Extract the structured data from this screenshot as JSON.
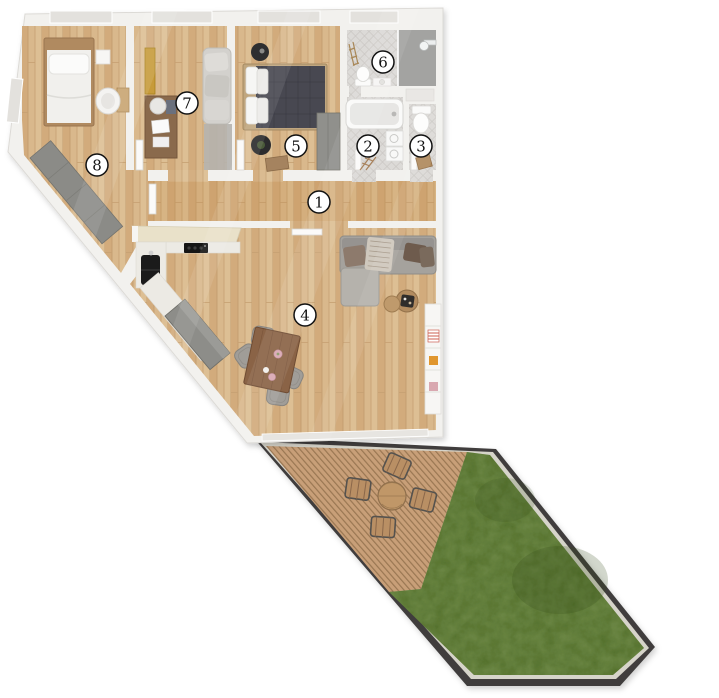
{
  "floorplan": {
    "type": "apartment-top-view-3d-floor-plan",
    "rooms": [
      {
        "number": "1"
      },
      {
        "number": "2"
      },
      {
        "number": "3"
      },
      {
        "number": "4"
      },
      {
        "number": "5"
      },
      {
        "number": "6"
      },
      {
        "number": "7"
      },
      {
        "number": "8"
      }
    ],
    "badge": {
      "fill": "#ffffff",
      "border": "#111111"
    },
    "colors": {
      "wall": "#f2f1ee",
      "wall_edge": "#dcdad6",
      "wood_floor": "#d9b88c",
      "hall_tint": "rgba(186,122,52,0.16)",
      "tile_floor": "#dcdad7",
      "shower_floor": "#a3a3a1",
      "deck_wood": "#c89f78",
      "deck_slat": "#9a7753",
      "grass": "#527029",
      "terrace_border": "#3f3e3c",
      "terrace_frame": "#d6d4ca",
      "furniture_gray": "#8d8d89",
      "sofa_gray": "#a5a29d",
      "bed_duvet_dark": "#484851",
      "kitchen_cream": "#e9e1c9",
      "counter_marble": "#eceae4",
      "cabinet_mustard": "#c79b3a",
      "wood_furniture": "#8a6346"
    }
  }
}
